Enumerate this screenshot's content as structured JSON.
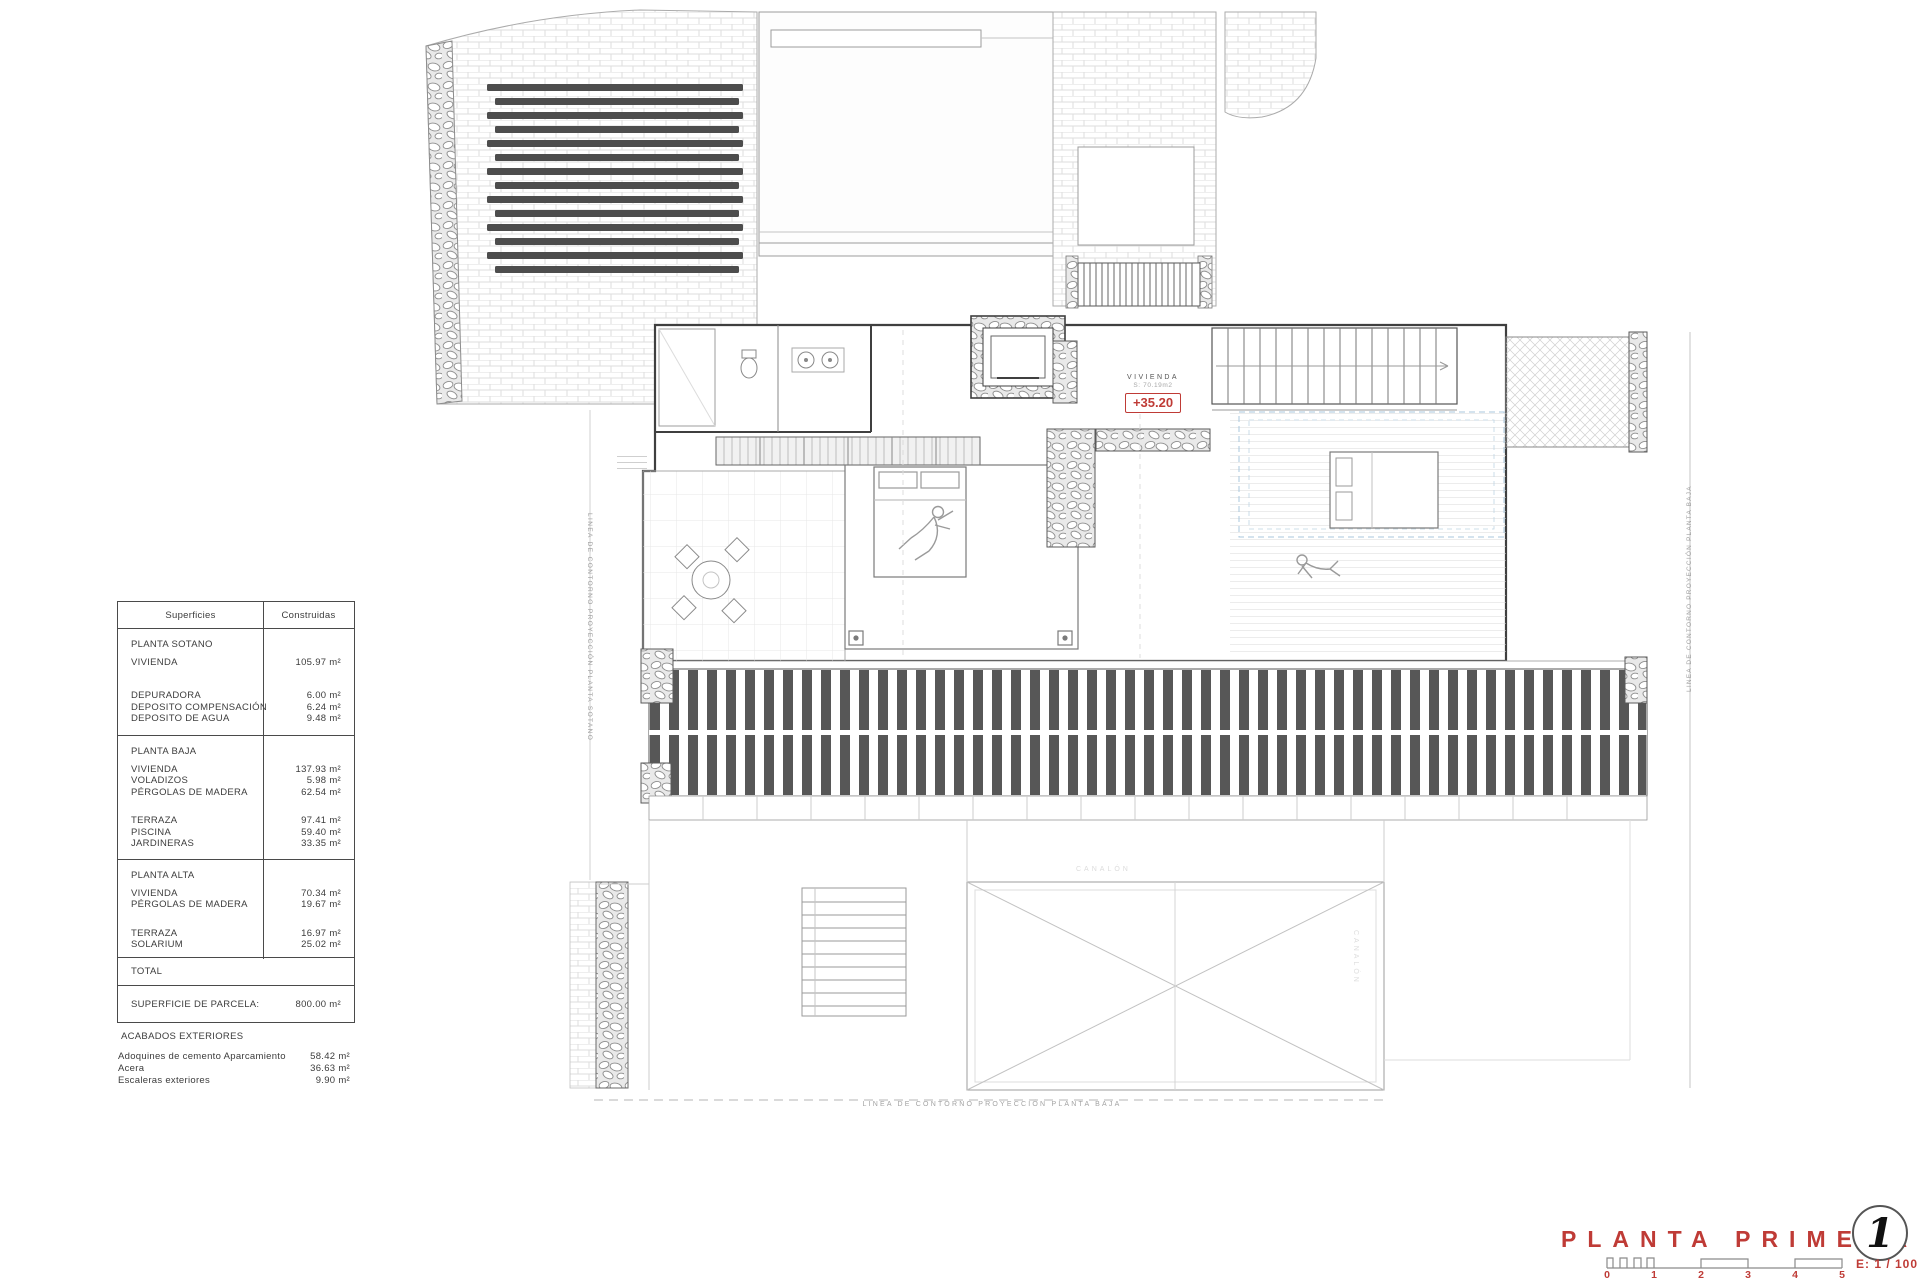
{
  "colors": {
    "red": "#bf3b36"
  },
  "surface_table": {
    "header": {
      "superficies": "Superficies",
      "construidas": "Construidas"
    },
    "sotano": {
      "title": "PLANTA SOTANO",
      "rows": [
        {
          "label": "VIVIENDA",
          "value": "105.97 m²"
        },
        {
          "label": "DEPURADORA",
          "value": "6.00 m²"
        },
        {
          "label": "DEPOSITO COMPENSACIÓN",
          "value": "6.24 m²"
        },
        {
          "label": "DEPOSITO DE AGUA",
          "value": "9.48 m²"
        }
      ]
    },
    "baja": {
      "title": "PLANTA BAJA",
      "rows": [
        {
          "label": "VIVIENDA",
          "value": "137.93 m²"
        },
        {
          "label": "VOLADIZOS",
          "value": "5.98 m²"
        },
        {
          "label": "PÉRGOLAS DE MADERA",
          "value": "62.54 m²"
        },
        {
          "label": "TERRAZA",
          "value": "97.41 m²"
        },
        {
          "label": "PISCINA",
          "value": "59.40 m²"
        },
        {
          "label": "JARDINERAS",
          "value": "33.35 m²"
        }
      ]
    },
    "alta": {
      "title": "PLANTA ALTA",
      "rows": [
        {
          "label": "VIVIENDA",
          "value": "70.34 m²"
        },
        {
          "label": "PÉRGOLAS DE MADERA",
          "value": "19.67 m²"
        },
        {
          "label": "TERRAZA",
          "value": "16.97 m²"
        },
        {
          "label": "SOLARIUM",
          "value": "25.02 m²"
        }
      ]
    },
    "total_label": "TOTAL",
    "parcela_label": "SUPERFICIE DE PARCELA:",
    "parcela_value": "800.00 m²"
  },
  "acabados": {
    "title": "ACABADOS EXTERIORES",
    "rows": [
      {
        "label": "Adoquines de cemento Aparcamiento",
        "value": "58.42 m²"
      },
      {
        "label": "Acera",
        "value": "36.63 m²"
      },
      {
        "label": "Escaleras exteriores",
        "value": "9.90 m²"
      }
    ]
  },
  "plan": {
    "room_label": "VIVIENDA",
    "room_area": "S: 70.19m2",
    "room_level": "+35.20",
    "boundary_right": "LINEA DE CONTORNO PROYECCIÓN PLANTA BAJA",
    "boundary_bottom": "LINEA DE CONTORNO PROYECCIÓN PLANTA BAJA",
    "boundary_left": "LINEA DE CONTORNO PROYECCIÓN PLANTA SOTANO",
    "gutter_label_h": "CANALÓN",
    "gutter_label_v": "CANALÓN"
  },
  "titleblock": {
    "title": "PLANTA PRIMERA",
    "sheet_number": "1",
    "scale_text": "E: 1 / 100",
    "ticks": [
      "0",
      "1",
      "2",
      "3",
      "4",
      "5"
    ]
  }
}
